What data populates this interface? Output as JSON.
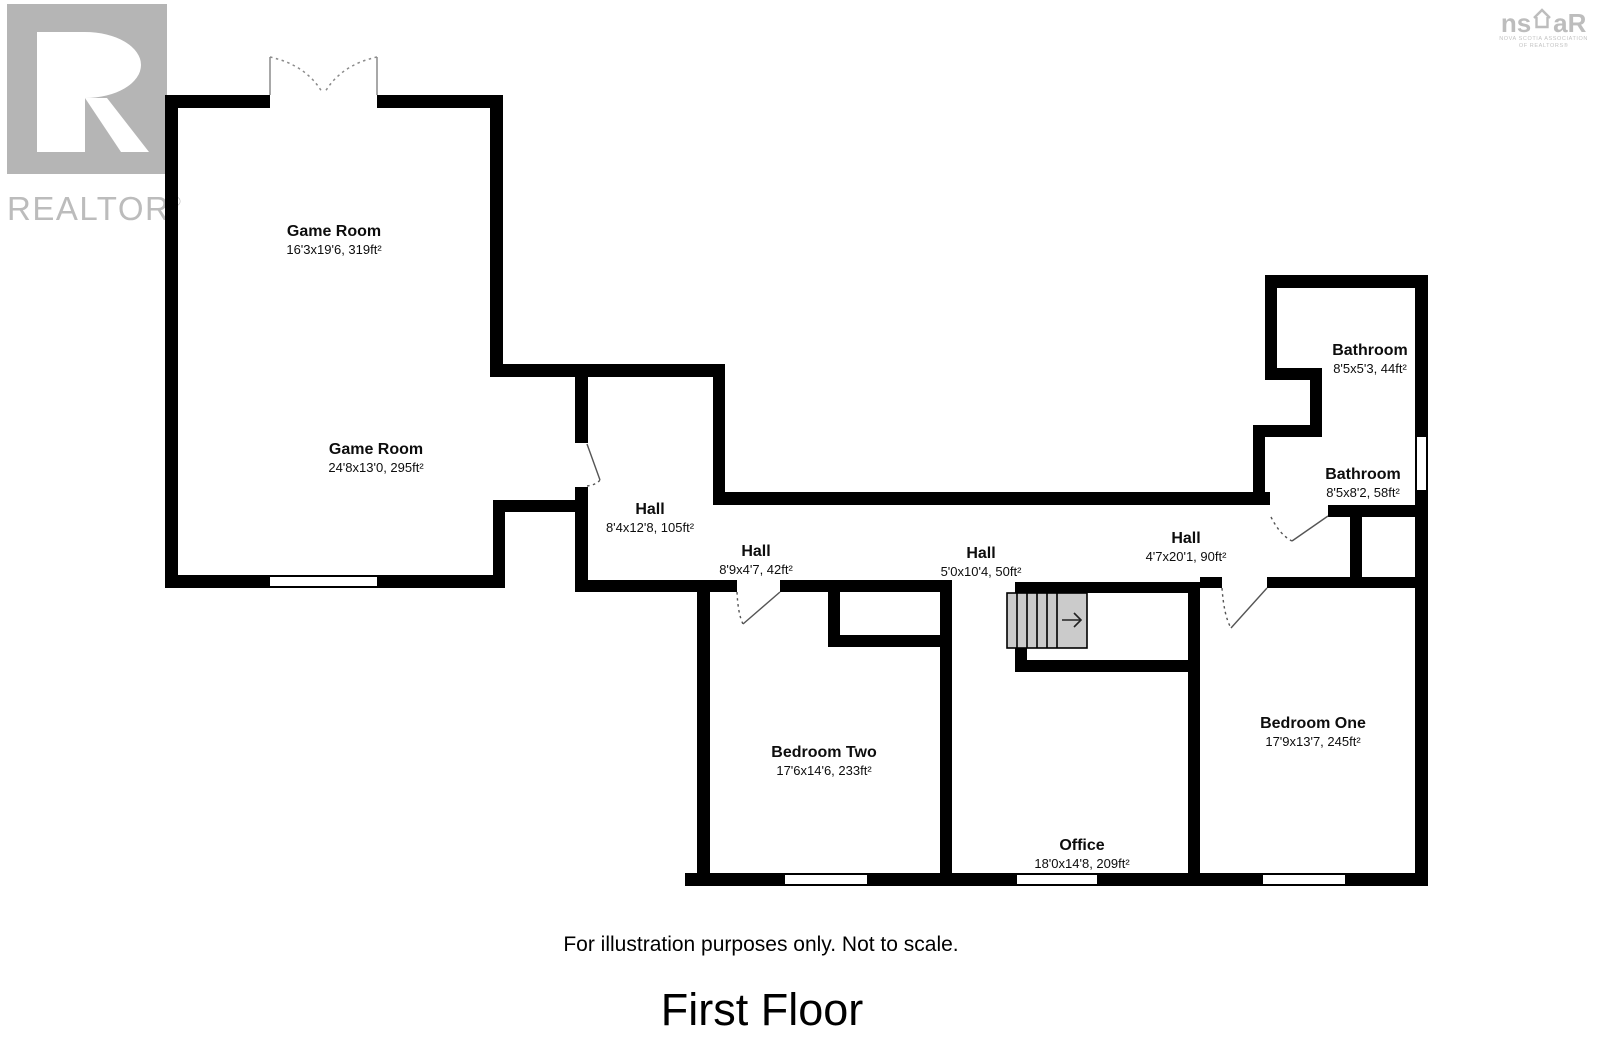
{
  "watermarks": {
    "realtor": {
      "word": "REALTOR",
      "registered": "®",
      "color": "#b5b5b5"
    },
    "nsar": {
      "left": "ns",
      "right": "aR",
      "sub1": "NOVA SCOTIA ASSOCIATION",
      "sub2": "OF REALTORS®",
      "color": "#bdbdbd"
    }
  },
  "rooms": [
    {
      "id": "game-room-upper",
      "name": "Game Room",
      "dims": "16'3x19'6, 319ft²"
    },
    {
      "id": "game-room-lower",
      "name": "Game Room",
      "dims": "24'8x13'0, 295ft²"
    },
    {
      "id": "hall-main",
      "name": "Hall",
      "dims": "8'4x12'8, 105ft²"
    },
    {
      "id": "hall-west",
      "name": "Hall",
      "dims": "8'9x4'7, 42ft²"
    },
    {
      "id": "hall-center",
      "name": "Hall",
      "dims": "5'0x10'4, 50ft²"
    },
    {
      "id": "hall-east",
      "name": "Hall",
      "dims": "4'7x20'1, 90ft²"
    },
    {
      "id": "bathroom-upper",
      "name": "Bathroom",
      "dims": "8'5x5'3, 44ft²"
    },
    {
      "id": "bathroom-lower",
      "name": "Bathroom",
      "dims": "8'5x8'2, 58ft²"
    },
    {
      "id": "bedroom-two",
      "name": "Bedroom Two",
      "dims": "17'6x14'6, 233ft²"
    },
    {
      "id": "bedroom-one",
      "name": "Bedroom One",
      "dims": "17'9x13'7, 245ft²"
    },
    {
      "id": "office",
      "name": "Office",
      "dims": "18'0x14'8, 209ft²"
    }
  ],
  "footer": {
    "disclaimer": "For illustration purposes only. Not to scale.",
    "floor_title": "First Floor"
  },
  "colors": {
    "wall": "#000000",
    "stairs_fill": "#cbcbcb",
    "door_swing": "#555555"
  }
}
